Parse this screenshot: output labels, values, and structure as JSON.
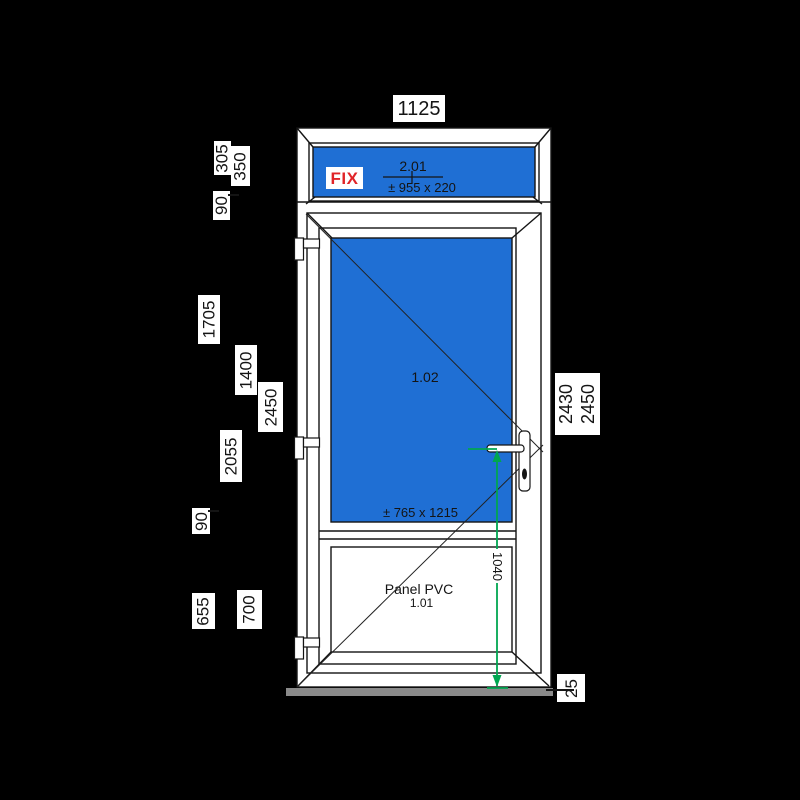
{
  "colors": {
    "background": "#000000",
    "frame_white": "#ffffff",
    "outline_black": "#141414",
    "glass_blue": "#1f6fd4",
    "dimension_green": "#00a651",
    "fix_red": "#e02428",
    "threshold_gray": "#8a8a8a"
  },
  "dimensions": {
    "top_width": "1125",
    "left": {
      "transom_glass_zone": "305",
      "transom_section": "350",
      "transom_profile": "90",
      "top_to_rail": "1705",
      "door_glass_section": "1400",
      "total_height": "2450",
      "below_transom": "2055",
      "rail_profile": "90",
      "panel_zone": "655",
      "panel_section": "700"
    },
    "right": {
      "leaf_height": "2430",
      "total_height": "2450",
      "threshold_height": "25"
    },
    "handle_height": "1040"
  },
  "transom": {
    "tag": "FIX",
    "code": "2.01",
    "glass_size": "± 955 x 220"
  },
  "door": {
    "code": "1.02",
    "glass_size": "± 765 x 1215"
  },
  "panel": {
    "label": "Panel PVC",
    "code": "1.01"
  }
}
